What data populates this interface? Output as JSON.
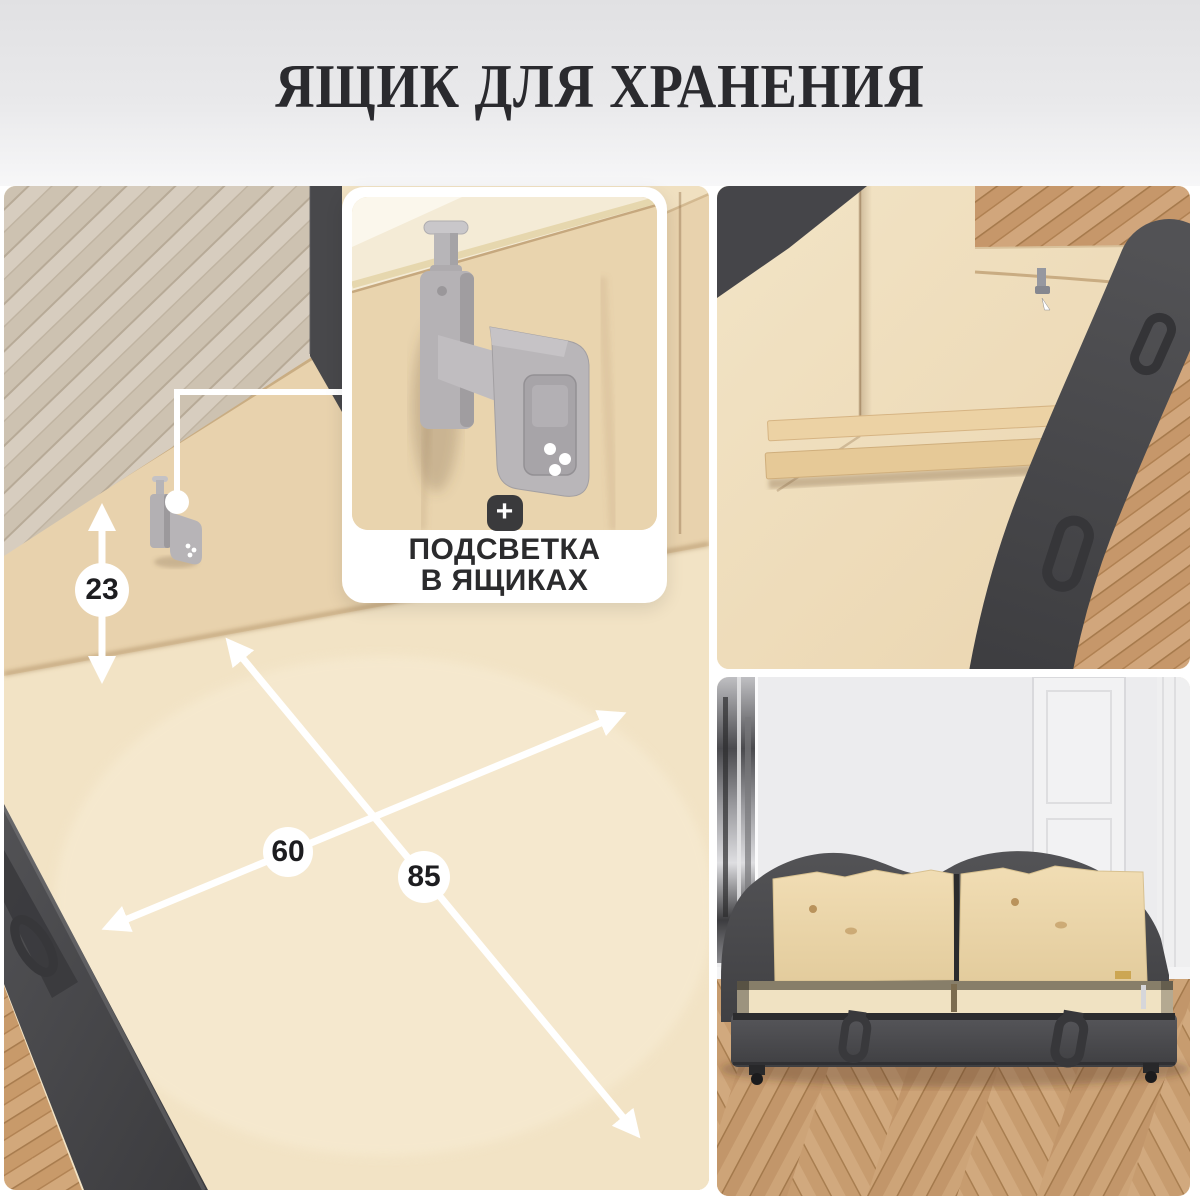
{
  "header": {
    "title": "ЯЩИК ДЛЯ ХРАНЕНИЯ"
  },
  "feature_card": {
    "plus": "+",
    "line1": "ПОДСВЕТКА",
    "line2": "В ЯЩИКАХ"
  },
  "dimensions": {
    "height": "23",
    "width": "60",
    "length": "85"
  },
  "colors": {
    "header_bg_top": "#e1e1e3",
    "header_bg_bottom": "#f7f7f8",
    "title_text": "#2a2a2e",
    "plus_badge_bg": "#3a3a3c",
    "annotation_white": "#ffffff",
    "fabric_dark": "#47474a",
    "plywood_light": "#ecd8b6",
    "parquet_warm": "#c79a6c",
    "parquet_gray": "#d4c9ba",
    "wall_white": "#ececed"
  }
}
